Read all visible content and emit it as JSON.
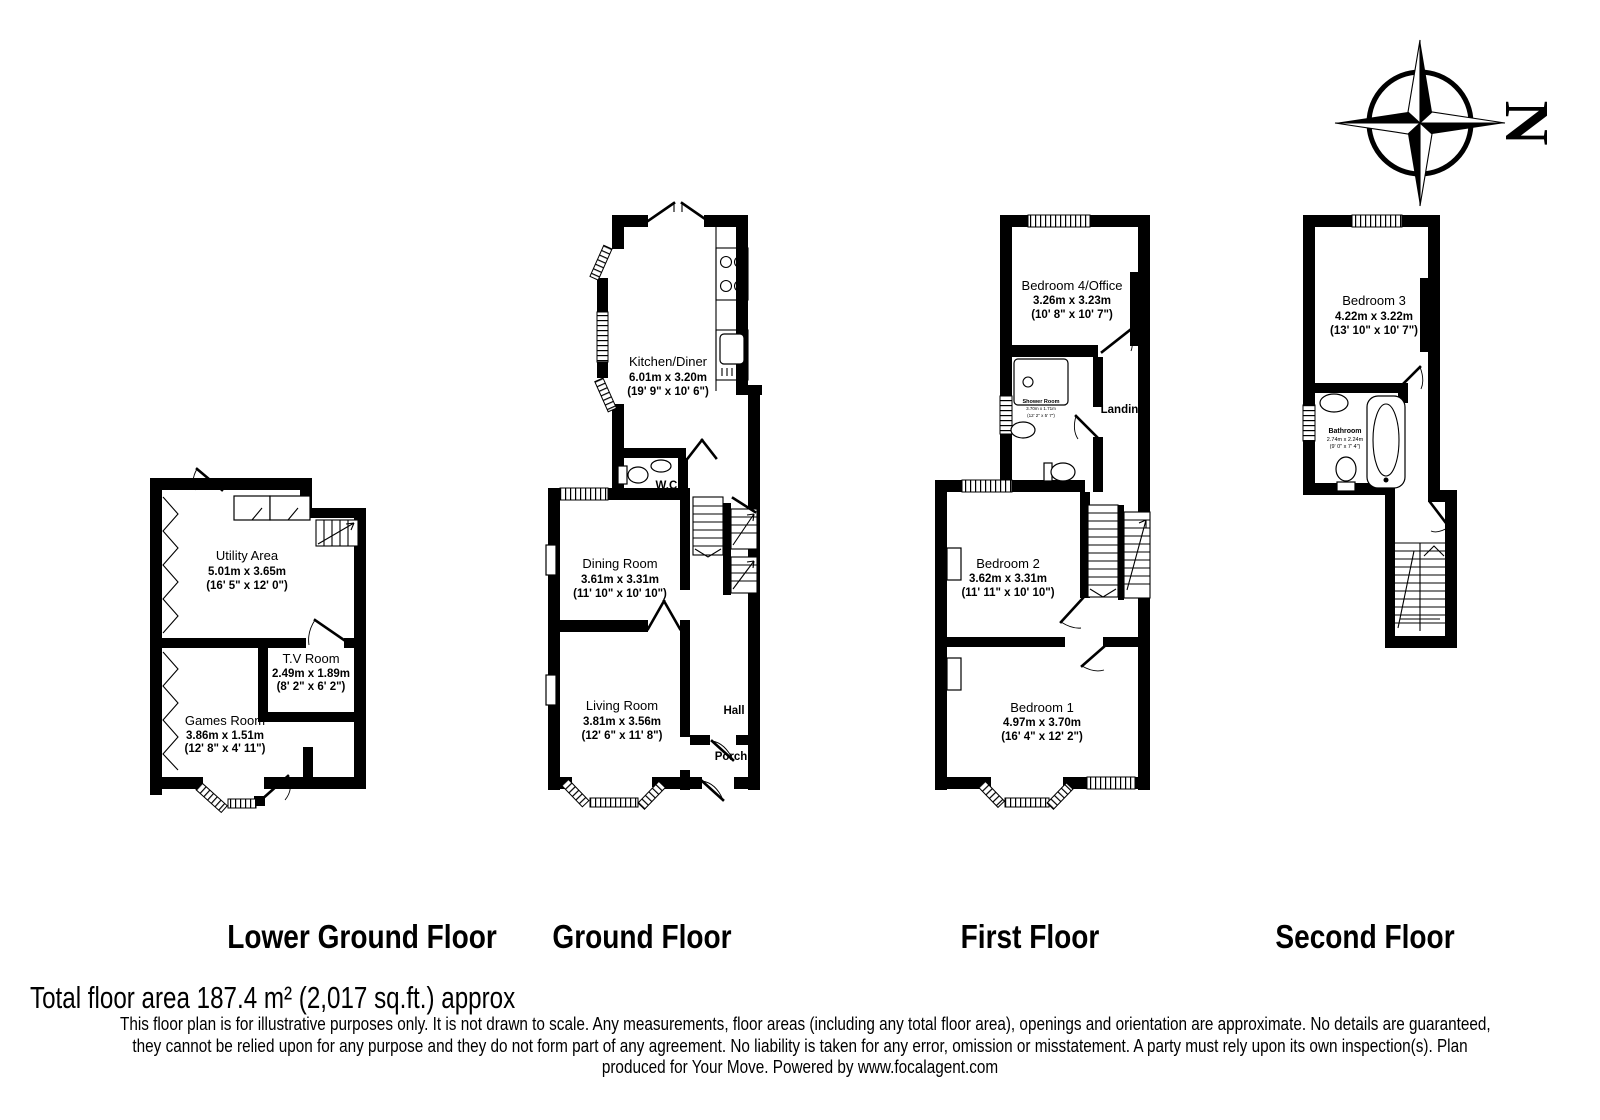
{
  "compass": {
    "letter": "N"
  },
  "floors": [
    {
      "id": "lower-ground",
      "title": "Lower Ground Floor",
      "rooms": [
        {
          "name": "Utility Area",
          "metric": "5.01m x 3.65m",
          "imperial": "(16' 5\" x 12' 0\")"
        },
        {
          "name": "T.V Room",
          "metric": "2.49m x 1.89m",
          "imperial": "(8' 2\" x 6' 2\")"
        },
        {
          "name": "Games Room",
          "metric": "3.86m x 1.51m",
          "imperial": "(12' 8\" x 4' 11\")"
        }
      ]
    },
    {
      "id": "ground",
      "title": "Ground Floor",
      "rooms": [
        {
          "name": "Kitchen/Diner",
          "metric": "6.01m x 3.20m",
          "imperial": "(19' 9\" x 10' 6\")"
        },
        {
          "name": "W.C."
        },
        {
          "name": "Dining Room",
          "metric": "3.61m x 3.31m",
          "imperial": "(11' 10\" x 10' 10\")"
        },
        {
          "name": "Living Room",
          "metric": "3.81m x 3.56m",
          "imperial": "(12' 6\" x 11' 8\")"
        },
        {
          "name": "Hall"
        },
        {
          "name": "Porch"
        }
      ]
    },
    {
      "id": "first",
      "title": "First Floor",
      "rooms": [
        {
          "name": "Bedroom 4/Office",
          "metric": "3.26m x 3.23m",
          "imperial": "(10' 8\" x 10' 7\")"
        },
        {
          "name": "Shower Room",
          "metric": "3.70m x 1.71m",
          "imperial": "(12' 2\" x 5' 7\")"
        },
        {
          "name": "Landing"
        },
        {
          "name": "Bedroom 2",
          "metric": "3.62m x 3.31m",
          "imperial": "(11' 11\" x 10' 10\")"
        },
        {
          "name": "Bedroom 1",
          "metric": "4.97m x 3.70m",
          "imperial": "(16' 4\" x 12' 2\")"
        }
      ]
    },
    {
      "id": "second",
      "title": "Second Floor",
      "rooms": [
        {
          "name": "Bedroom 3",
          "metric": "4.22m x 3.22m",
          "imperial": "(13' 10\" x 10' 7\")"
        },
        {
          "name": "Bathroom",
          "metric": "2.74m x 2.24m",
          "imperial": "(9' 0\" x 7' 4\")"
        }
      ]
    }
  ],
  "footer": {
    "total": "Total floor area 187.4 m² (2,017 sq.ft.) approx",
    "disclaimer_lines": [
      "This floor plan is for illustrative purposes only. It is not drawn to scale. Any measurements, floor areas (including any total floor area), openings and orientation are approximate. No details are guaranteed,",
      "they cannot be relied upon for any purpose and they do not form part of any agreement. No liability is taken for any error, omission or misstatement. A party must rely upon its own inspection(s).  Plan",
      "produced for Your Move. Powered by www.focalagent.com"
    ]
  }
}
